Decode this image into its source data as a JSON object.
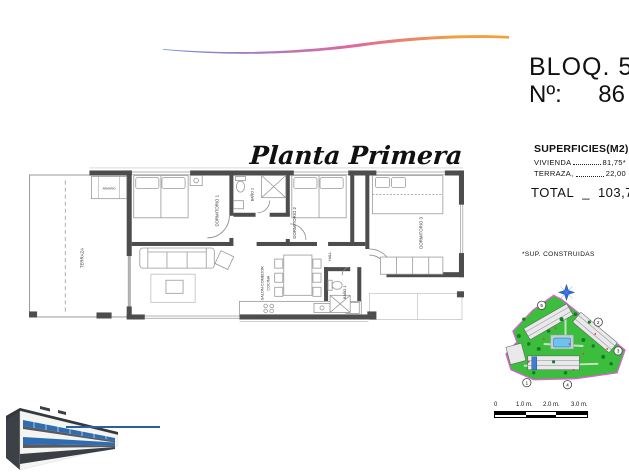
{
  "header": {
    "block": "BLOQ. 5",
    "number_label": "Nº:",
    "number_value": "86"
  },
  "surfaces": {
    "title": "SUPERFICIES(M2)",
    "rows": [
      {
        "label": "VIVIENDA",
        "value": "81,75*"
      },
      {
        "label": "TERRAZA,",
        "value": "22,00"
      }
    ],
    "total_label": "TOTAL",
    "total_sep": "_",
    "total_value": "103,75",
    "footnote": "*SUP. CONSTRUIDAS"
  },
  "plan": {
    "title": "Planta Primera",
    "rooms": {
      "terraza": "TERRAZA",
      "armario": "ARMARIO",
      "dormitorio1": "DORMITORIO 1",
      "bano2": "BAÑO 2",
      "dormitorio2": "DORMITORIO 2",
      "dormitorio3": "DORMITORIO 3",
      "salon_line1": "SALON-COMEDOR",
      "salon_line2": "COCINA",
      "hall": "HALL",
      "bano1": "BAÑO 1"
    }
  },
  "scale_bar": {
    "labels": [
      "0",
      "1.0 m.",
      "2.0 m.",
      "3.0 m."
    ]
  },
  "site_map": {
    "blocks": [
      "1",
      "2",
      "3",
      "4",
      "5"
    ]
  },
  "colors": {
    "swoosh_blue": "#6f8fd4",
    "swoosh_pink": "#e0679f",
    "swoosh_orange": "#f2a03c",
    "site_green": "#3cbd3e",
    "site_boundary_pink": "#df5fd5",
    "pool_blue": "#6cc4ee",
    "render_line_blue": "#2b5f9e",
    "window_blue": "#2e6db4",
    "wall_gray": "#4d4d4d"
  }
}
